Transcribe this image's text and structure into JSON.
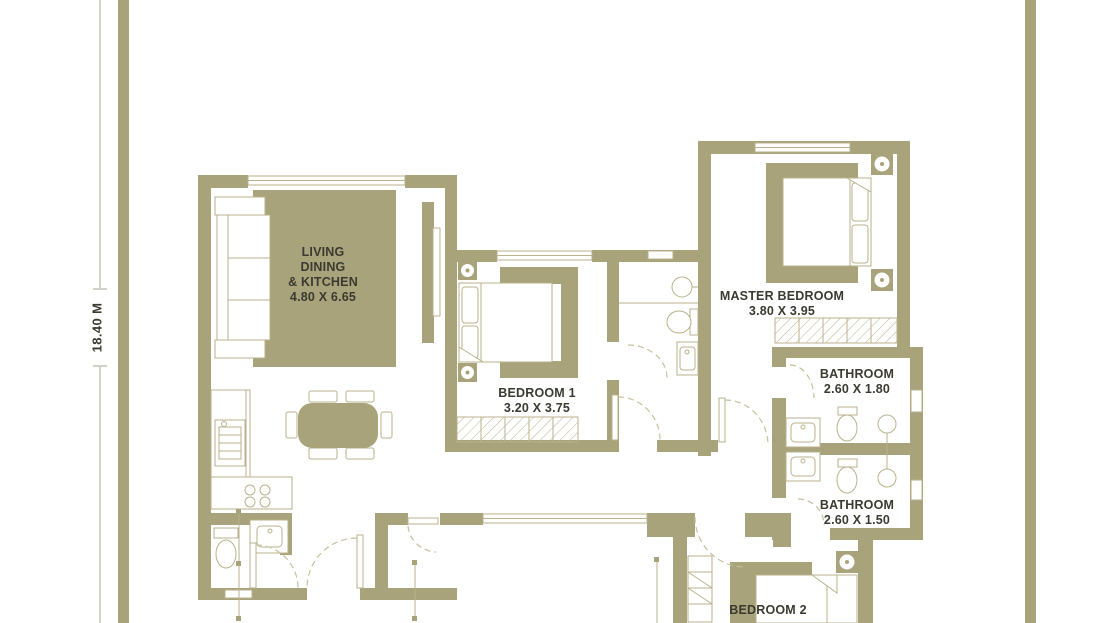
{
  "dimension_label": "18.40 M",
  "rooms": {
    "living": {
      "line1": "LIVING",
      "line2": "DINING",
      "line3": "& KITCHEN",
      "dims": "4.80 X 6.65"
    },
    "bedroom1": {
      "name": "BEDROOM 1",
      "dims": "3.20 X 3.75"
    },
    "master_bedroom": {
      "name": "MASTER BEDROOM",
      "dims": "3.80 X 3.95"
    },
    "bathroom_top": {
      "name": "BATHROOM",
      "dims": "2.60 X 1.80"
    },
    "bathroom_bottom": {
      "name": "BATHROOM",
      "dims": "2.60 X 1.50"
    },
    "bedroom2": {
      "name": "BEDROOM 2"
    }
  },
  "colors": {
    "wall": "#a8a37a",
    "furniture_line": "#b9b28b",
    "arc_line": "#c6c09b",
    "text": "#3b3a31",
    "background": "#ffffff"
  }
}
